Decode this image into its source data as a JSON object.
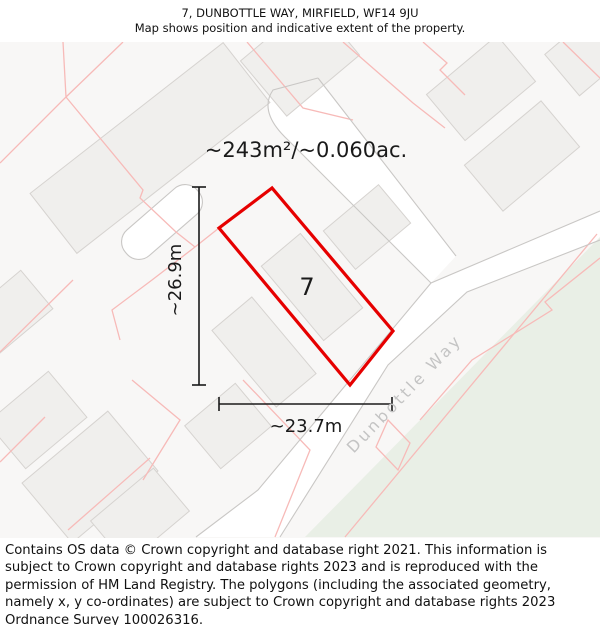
{
  "header": {
    "title": "7, DUNBOTTLE WAY, MIRFIELD, WF14 9JU",
    "subtitle": "Map shows position and indicative extent of the property."
  },
  "map": {
    "area_label": "~243m²/~0.060ac.",
    "plot_label": "7",
    "dim_vertical_label": "~26.9m",
    "dim_horizontal_label": "~23.7m",
    "road_name": "Dunbottle Way",
    "colors": {
      "property_boundary_red": "#e60000",
      "parcel_line_pink": "#f7bab8",
      "building_fill": "#f0efed",
      "building_stroke": "#d6d3d0",
      "road_edge_gray": "#c9c7c5",
      "green_area": "#e9efe6",
      "map_background": "#f8f7f6",
      "road_label_gray": "#c4c4c4",
      "dimension_black": "#1a1a1a"
    }
  },
  "footer": {
    "text": "Contains OS data © Crown copyright and database right 2021. This information is subject to Crown copyright and database rights 2023 and is reproduced with the permission of HM Land Registry. The polygons (including the associated geometry, namely x, y co-ordinates) are subject to Crown copyright and database rights 2023 Ordnance Survey 100026316."
  }
}
